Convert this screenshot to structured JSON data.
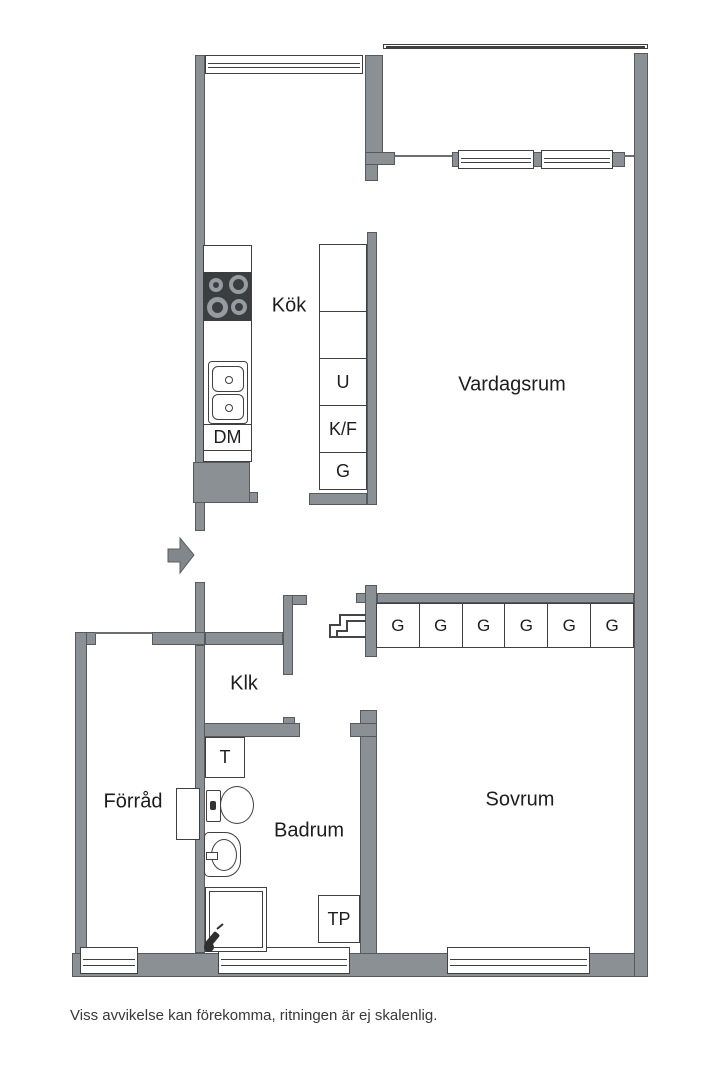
{
  "plan": {
    "rooms": {
      "kitchen": "Kök",
      "living_room": "Vardagsrum",
      "closet": "Klk",
      "storage": "Förråd",
      "bathroom": "Badrum",
      "bedroom": "Sovrum"
    },
    "labels": {
      "dishwasher": "DM",
      "oven": "U",
      "fridge_freezer": "K/F",
      "cabinet": "G",
      "dryer": "T",
      "laundry_tower": "TP"
    },
    "wardrobes": [
      "G",
      "G",
      "G",
      "G",
      "G",
      "G"
    ],
    "disclaimer": "Viss avvikelse kan förekomma, ritningen är ej skalenlig."
  },
  "colors": {
    "wall": "#8b9094",
    "outline": "#565a5e",
    "line": "#3f3f3f",
    "stove": "#3a3e41",
    "burner": "#969b9f",
    "text": "#1d1d1d",
    "arrow": "#82878b"
  }
}
